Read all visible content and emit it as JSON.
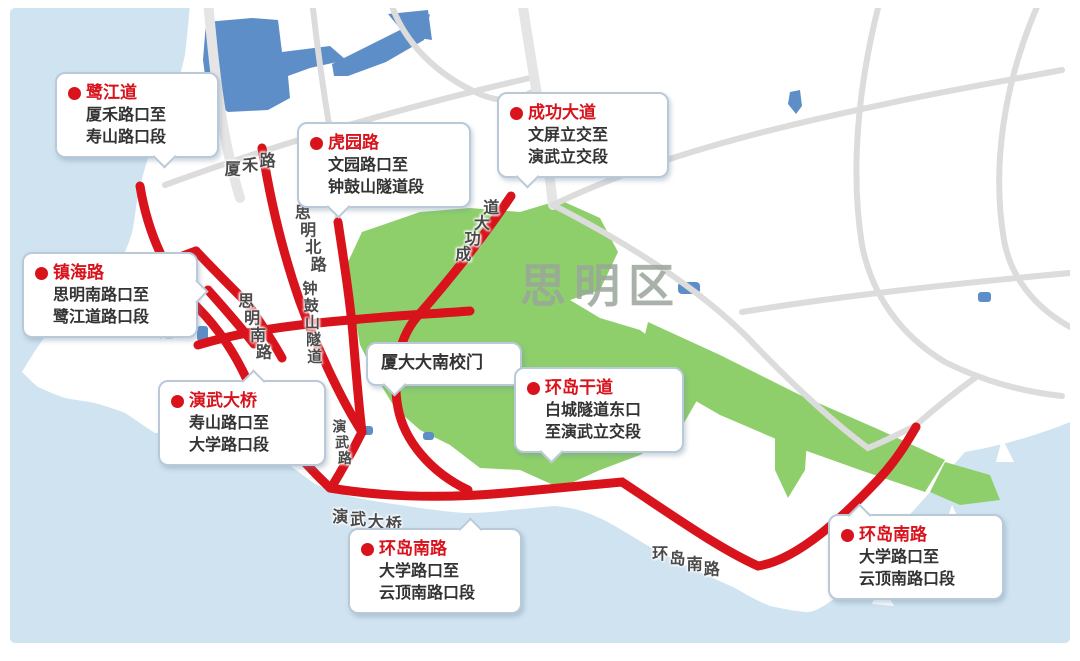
{
  "map": {
    "region_label": "思明区",
    "colors": {
      "sea": "#cfe3f1",
      "land": "#ffffff",
      "park": "#8ecf6c",
      "lake": "#5d8ec8",
      "gray_road": "#dcdcdc",
      "highlight_road": "#d8131c",
      "callout_border": "#b9c9d8",
      "body_text": "#333333",
      "label_text": "#4a4a4a",
      "region_text": "#9aa59a"
    },
    "callouts": [
      {
        "title": "鹭江道",
        "dot": true,
        "lines": [
          "厦禾路口至",
          "寿山路口段"
        ],
        "left": 55,
        "top": 72,
        "width": 138,
        "tail": "down",
        "tail_offset": 62
      },
      {
        "title": "虎园路",
        "dot": true,
        "lines": [
          "文园路口至",
          "钟鼓山隧道段"
        ],
        "left": 297,
        "top": 122,
        "width": 148,
        "tail": "down",
        "tail_offset": 18
      },
      {
        "title": "成功大道",
        "dot": true,
        "lines": [
          "文屏立交至",
          "演武立交段"
        ],
        "left": 497,
        "top": 92,
        "width": 146,
        "tail": "down",
        "tail_offset": 12
      },
      {
        "title": "镇海路",
        "dot": true,
        "lines": [
          "思明南路口至",
          "鹭江道路口段"
        ],
        "left": 22,
        "top": 252,
        "width": 150,
        "tail": "right",
        "tail_offset": 35
      },
      {
        "title": "演武大桥",
        "dot": true,
        "lines": [
          "寿山路口至",
          "大学路口段"
        ],
        "left": 158,
        "top": 380,
        "width": 142,
        "tail": "up",
        "tail_offset": 52
      },
      {
        "title": "",
        "dot": false,
        "lines": [
          "厦大大南校门"
        ],
        "left": 366,
        "top": 342,
        "width": 130,
        "tail": "down",
        "tail_offset": 12,
        "plain": true
      },
      {
        "title": "环岛干道",
        "dot": true,
        "lines": [
          "白城隧道东口",
          "至演武立交段"
        ],
        "left": 514,
        "top": 367,
        "width": 144,
        "tail": "down",
        "tail_offset": 16
      },
      {
        "title": "环岛南路",
        "dot": true,
        "lines": [
          "大学路口至",
          "云顶南路口段"
        ],
        "left": 348,
        "top": 528,
        "width": 148,
        "tail": "up",
        "tail_offset": 66
      },
      {
        "title": "环岛南路",
        "dot": true,
        "lines": [
          "大学路口至",
          "云顶南路口段"
        ],
        "left": 828,
        "top": 514,
        "width": 150,
        "tail": "up",
        "tail_offset": 12
      }
    ],
    "road_labels": [
      {
        "text": "厦禾路",
        "x": 222,
        "y": 158,
        "angle": -14,
        "size": 16
      },
      {
        "text": "思明北路",
        "x": 312,
        "y": 200,
        "angle": 73,
        "size": 16
      },
      {
        "text": "思明南路",
        "x": 255,
        "y": 288,
        "angle": 71,
        "size": 16
      },
      {
        "text": "鹭江道",
        "x": 168,
        "y": 288,
        "angle": 78,
        "size": 15
      },
      {
        "text": "钟鼓山隧道",
        "x": 320,
        "y": 280,
        "angle": 86,
        "size": 15
      },
      {
        "text": "成功大道",
        "x": 449,
        "y": 253,
        "angle": -59,
        "size": 16
      },
      {
        "text": "演武路",
        "x": 348,
        "y": 418,
        "angle": 80,
        "size": 14
      },
      {
        "text": "演武大桥",
        "x": 334,
        "y": 502,
        "angle": 8,
        "size": 16
      },
      {
        "text": "环岛南路",
        "x": 656,
        "y": 538,
        "angle": 17,
        "size": 16
      },
      {
        "text": "思明区",
        "x": 520,
        "y": 250,
        "angle": 0,
        "size": 46,
        "region": true
      }
    ]
  }
}
